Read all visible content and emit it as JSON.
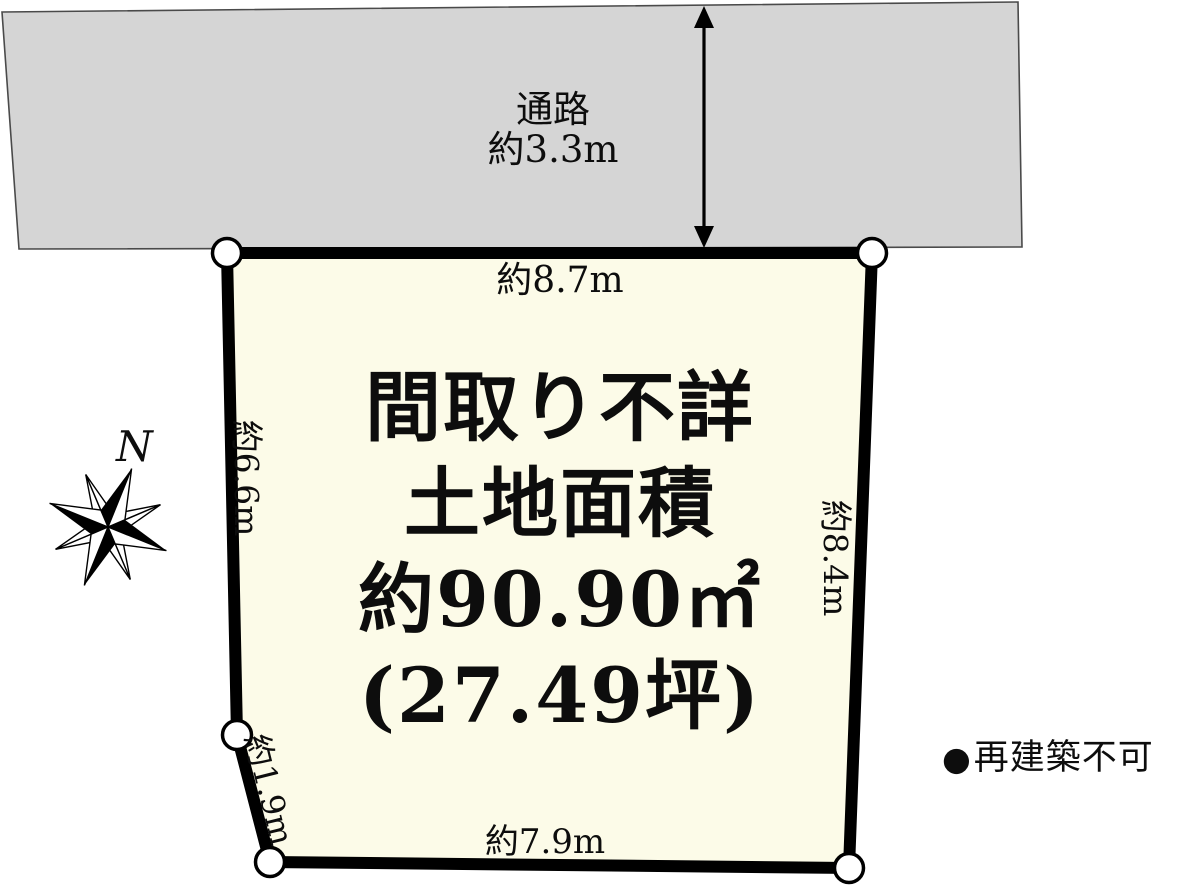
{
  "road": {
    "name_label": "通路",
    "width_label": "約3.3m"
  },
  "plot": {
    "top_dim": "約8.7m",
    "left_dim": "約6.6m",
    "right_dim": "約8.4m",
    "lower_left_dim": "約1.9m",
    "bottom_dim": "約7.9m",
    "center_lines": {
      "line1": "間取り不詳",
      "line2": "土地面積",
      "line3": "約90.90㎡",
      "line4": "(27.49坪)"
    }
  },
  "compass": {
    "north_label": "N"
  },
  "note": {
    "bullet": "●",
    "text": "再建築不可"
  },
  "colors": {
    "road-fill": "#d5d5d5",
    "road-stroke": "#4a4a4a",
    "plot-fill": "#fcfbe8",
    "line": "#000000",
    "text": "#0d0d0d"
  }
}
